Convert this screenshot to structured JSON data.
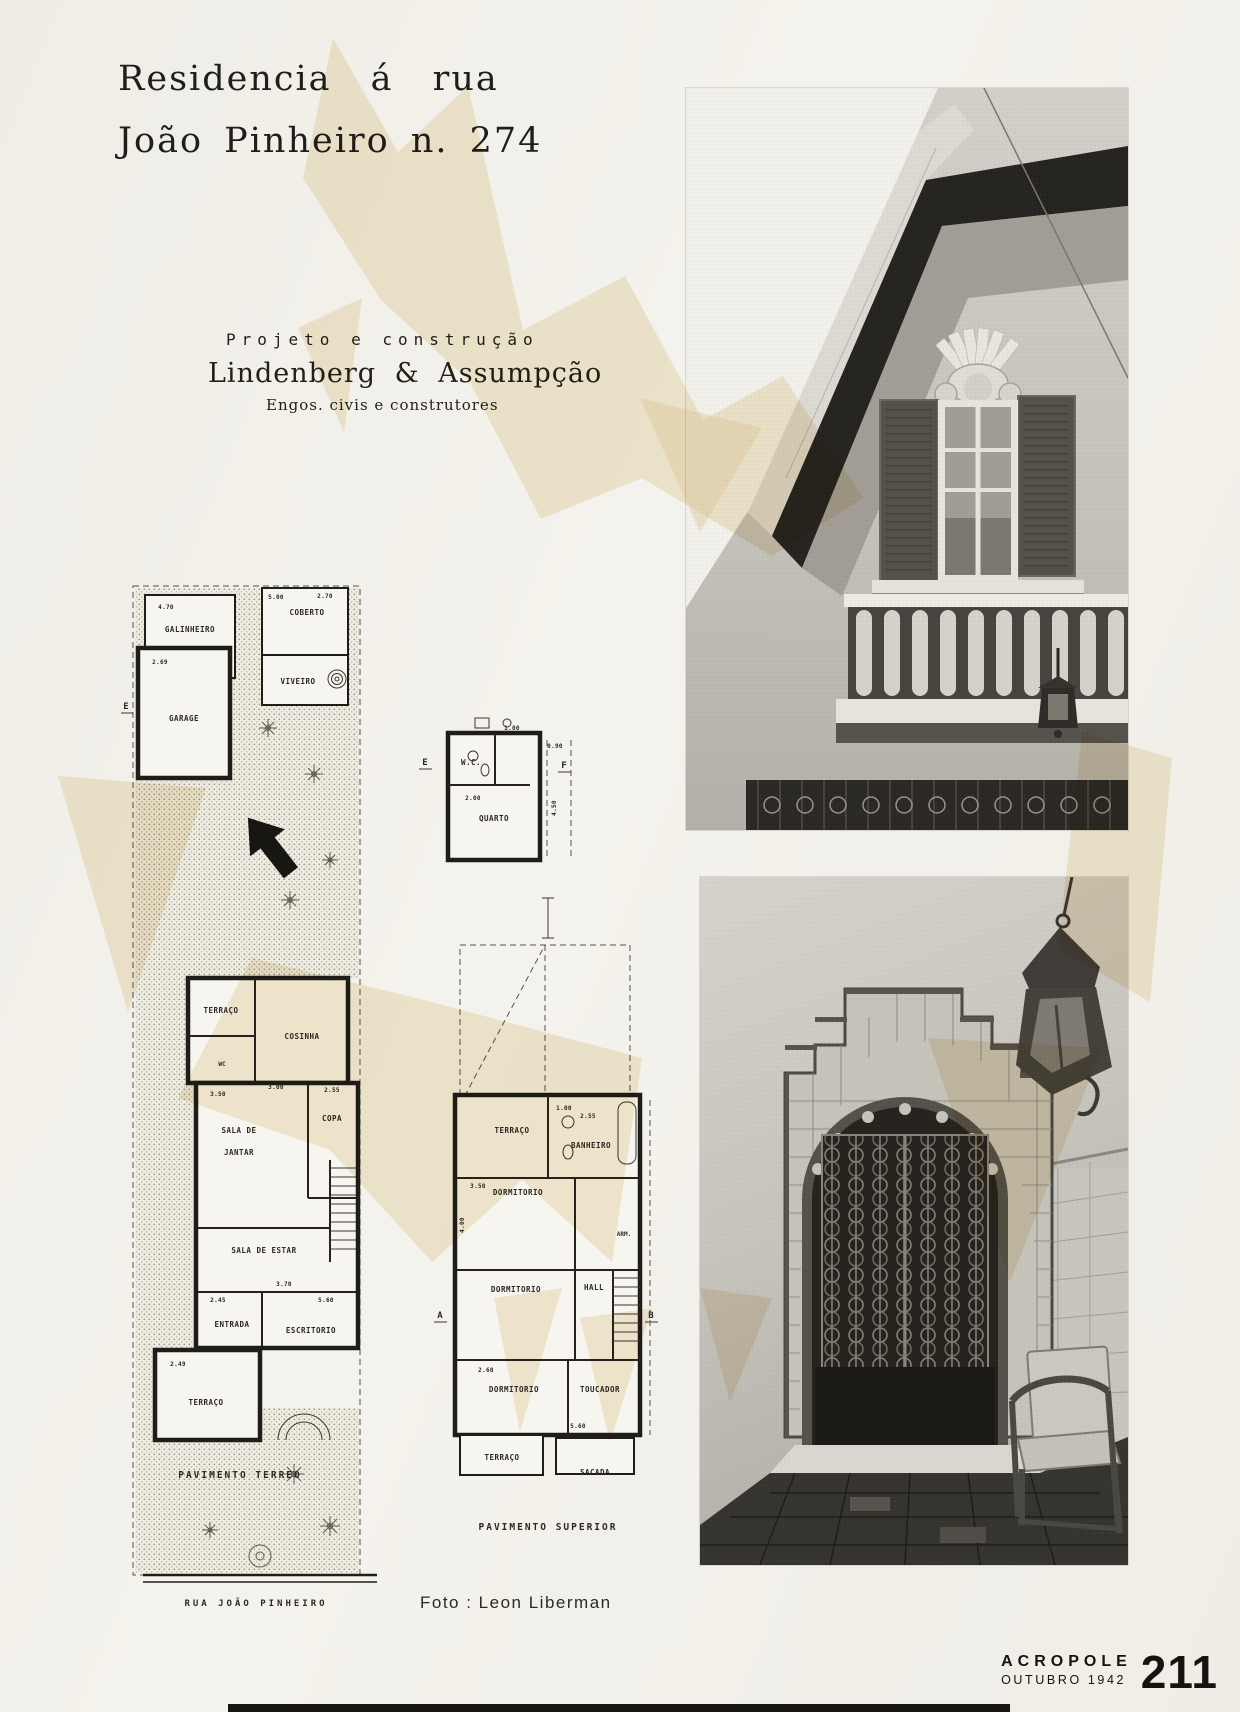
{
  "colors": {
    "paper": "#f2f0ea",
    "ink": "#1f1d1a",
    "stain": "#e7d2a0",
    "plan_line": "#26231f"
  },
  "header": {
    "title_line1": "Residencia á rua",
    "title_line2": "João Pinheiro n. 274"
  },
  "credit": {
    "line1": "Projeto e construção",
    "line2": "Lindenberg & Assumpção",
    "line3": "Engos. civis e construtores"
  },
  "photo_credit": "Foto : Leon Liberman",
  "footer": {
    "magazine": "ACROPOLE",
    "issue": "OUTUBRO 1942",
    "page": "211"
  },
  "ground_plan": {
    "caption": "PAVIMENTO TERREO",
    "street": "RUA JOÃO PINHEIRO",
    "marker_e": "E",
    "rooms": {
      "galinheiro": "GALINHEIRO",
      "coberto": "COBERTO",
      "viveiro": "VIVEIRO",
      "garage": "GARAGE",
      "terraco_kitchen": "TERRAÇO",
      "cosinha": "COSINHA",
      "wc": "WC",
      "sala_jantar_1": "SALA DE",
      "sala_jantar_2": "JANTAR",
      "copa": "COPA",
      "sala_estar": "SALA DE ESTAR",
      "entrada": "ENTRADA",
      "escritorio": "ESCRITORIO",
      "terraco_front": "TERRAÇO"
    },
    "dims": [
      "4.70",
      "2.69",
      "5.00",
      "2.70",
      "3.50",
      "2.55",
      "3.00",
      "2.45",
      "3.70",
      "5.60",
      "2.49"
    ]
  },
  "annex_plan": {
    "marker_e": "E",
    "marker_f": "F",
    "rooms": {
      "wc": "W.C.",
      "quarto": "QUARTO"
    },
    "dims": [
      "2.00",
      "1.00",
      "4.50",
      "0.90"
    ]
  },
  "upper_plan": {
    "caption": "PAVIMENTO SUPERIOR",
    "marker_a": "A",
    "marker_b": "B",
    "rooms": {
      "terraco_back": "TERRAÇO",
      "banheiro": "BANHEIRO",
      "dorm1": "DORMITORIO",
      "arm": "ARM.",
      "dorm2": "DORMITORIO",
      "hall": "HALL",
      "dorm3": "DORMITORIO",
      "toucador": "TOUCADOR",
      "terraco_front": "TERRAÇO",
      "sacada": "SACADA"
    },
    "dims": [
      "3.50",
      "2.55",
      "1.00",
      "4.00",
      "2.60",
      "5.60"
    ]
  }
}
